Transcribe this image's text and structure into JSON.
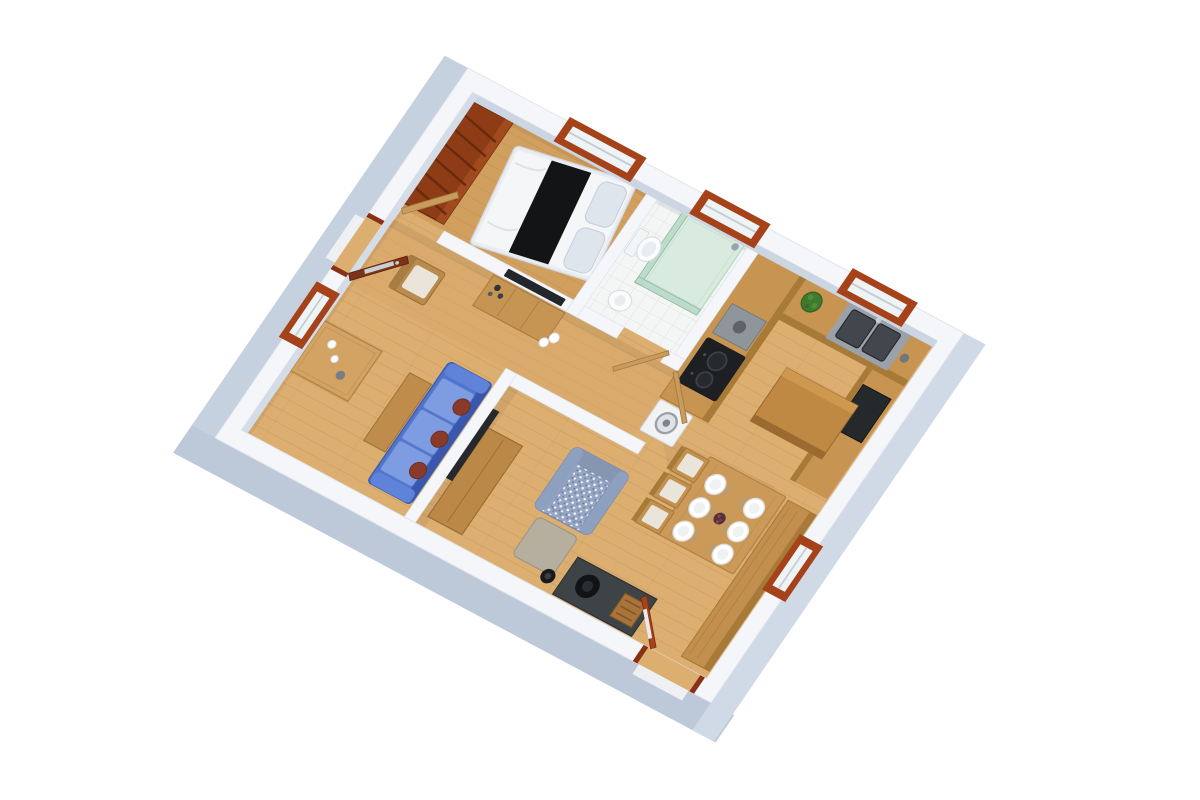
{
  "scene": {
    "type": "3d-floor-plan-render",
    "view": "rotated-isometric-top-down",
    "background": "#ffffff",
    "room_count": 7,
    "window_count": 5,
    "door_count": 5
  },
  "palette": {
    "wall_top": "#f4f6f9",
    "wall_inner_shade": "#ccd5e2",
    "wall_face_left": "#c6d1df",
    "wall_face_bottom": "#bdc9d9",
    "wall_face_right": "#d0dae6",
    "floor_wood": "#dcae70",
    "floor_bedroom": "#d2a05e",
    "bathroom_tile": "#f4f6f5",
    "counter_wood": "#c79551",
    "counter_front": "#a87a38",
    "island_wood": "#c08943",
    "table_wood": "#cc9a58",
    "bench_wood": "#c28f4e",
    "wardrobe_wood": "#8e3c16",
    "door_entry": "#7e3318",
    "door_exit": "#a8431c",
    "door_interior": "#c99c5e",
    "window_trim": "#a6421a",
    "sofa_blue": "#4f74cc",
    "sofa_seat": "#7d9ce2",
    "pillow_maroon": "#8a3a28",
    "armchair_fabric": "#96a5c2",
    "ottoman_gray": "#b6ae9f",
    "shower_glass": "#b9dcc8",
    "shower_tray": "#d9eadf",
    "appliance_black": "#26292c",
    "cooktop_black": "#1d1f22",
    "hood_gray": "#8e959b",
    "hearth_gray": "#3e4347",
    "plant_green": "#3f7a2e",
    "bed_runner": "#131416",
    "bed_white": "#f4f6f8",
    "fixture_white": "#fbfcfd"
  },
  "building": {
    "windows": [
      {
        "id": "bedroom-window",
        "wall": "top-right"
      },
      {
        "id": "bathroom-window",
        "wall": "top-right"
      },
      {
        "id": "kitchen-window",
        "wall": "top-right"
      },
      {
        "id": "hall-window",
        "wall": "top-left"
      },
      {
        "id": "dining-window",
        "wall": "bottom-right"
      }
    ],
    "doors": [
      {
        "id": "entry-door",
        "wall": "top-left",
        "style": "dark-red, glass panel, open"
      },
      {
        "id": "patio-door",
        "wall": "bottom-left",
        "style": "red glazed, open"
      },
      {
        "id": "bedroom-door",
        "style": "light wood, open"
      },
      {
        "id": "bathroom-door",
        "style": "light wood, open"
      },
      {
        "id": "kitchen-door",
        "style": "light wood, open"
      }
    ]
  },
  "rooms": {
    "bedroom": {
      "label": "bedroom",
      "furniture": [
        "double bed with black runner and white duvet",
        "open shelving wardrobe",
        "window"
      ]
    },
    "bathroom": {
      "label": "bathroom",
      "furniture": [
        "corner shower with green glass",
        "toilet",
        "pedestal sink",
        "white tile floor"
      ]
    },
    "corridor": {
      "label": "corridor",
      "furniture": [
        "wall TV",
        "wooden sideboard with cups",
        "chair with white cushion"
      ]
    },
    "entry_hall": {
      "label": "entry hall",
      "furniture": [
        "console table with cups",
        "entry door"
      ]
    },
    "living_area": {
      "label": "living area",
      "furniture": [
        "blue three-seat sofa with maroon pillows",
        "TV partition wall",
        "media console",
        "patterned armchair",
        "ottoman",
        "wood stove on dark hearth",
        "side table",
        "black bin"
      ]
    },
    "kitchen": {
      "label": "kitchen",
      "furniture": [
        "L-shaped counter",
        "double sink",
        "cooktop with hood",
        "black appliance",
        "washing machine",
        "island bar",
        "potted plant"
      ]
    },
    "dining_area": {
      "label": "dining area",
      "furniture": [
        "dining table with six place settings",
        "three cushioned chairs",
        "long wall bench"
      ]
    }
  }
}
